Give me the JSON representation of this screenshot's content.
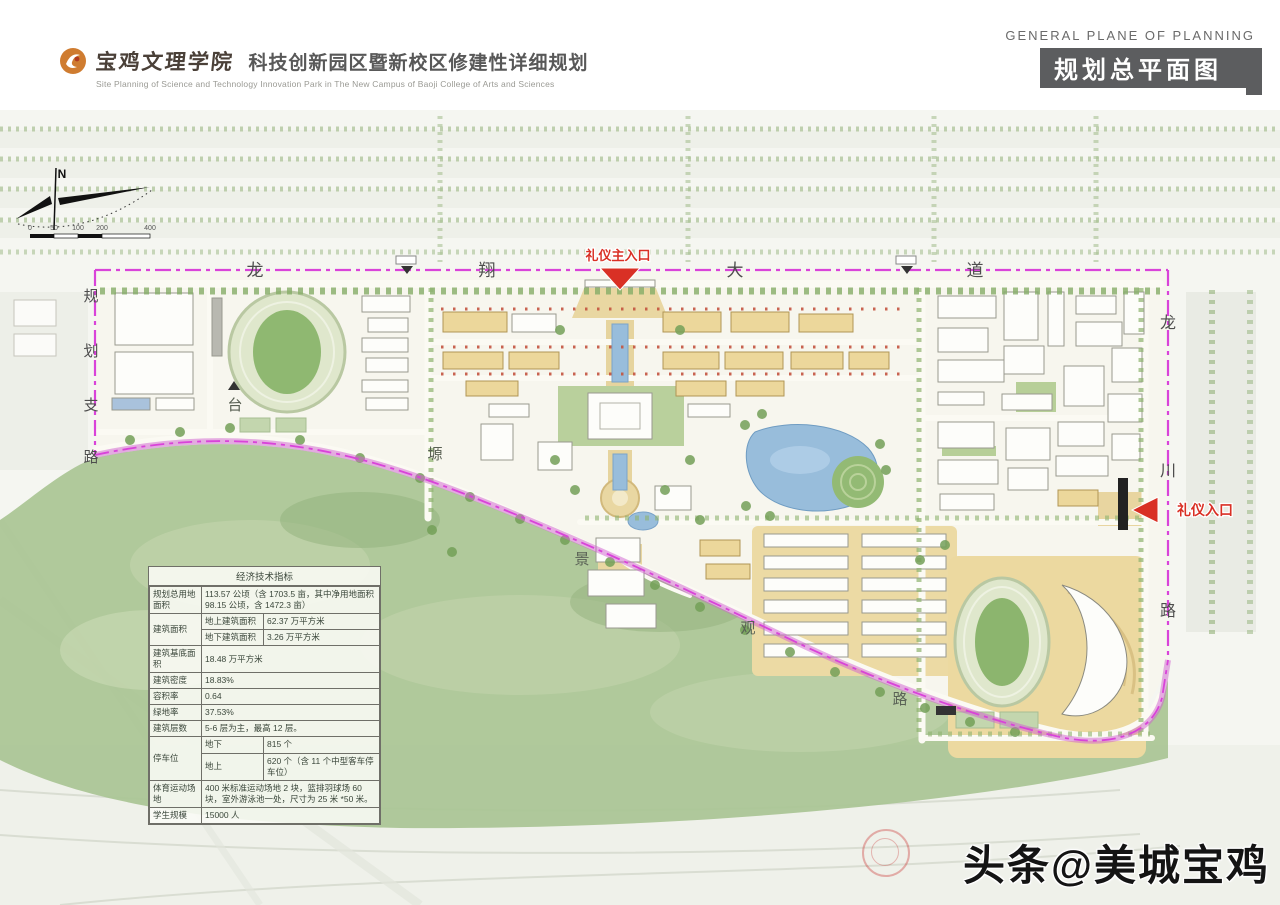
{
  "header": {
    "college": "宝鸡文理学院",
    "title_cn": "科技创新园区暨新校区修建性详细规划",
    "subtitle_en": "Site Planning of Science and Technology Innovation Park in The New Campus of Baoji College of Arts and Sciences",
    "right_title_en": "GENERAL PLANE OF PLANNING",
    "right_title_cn": "规划总平面图"
  },
  "map": {
    "compass_label": "N",
    "scale": {
      "ticks": [
        "0",
        "50",
        "100",
        "200",
        "400"
      ]
    },
    "roads": {
      "top": {
        "name": "龙翔大道",
        "chars": [
          "龙",
          "翔",
          "大",
          "道"
        ]
      },
      "left": {
        "name": "规划支路",
        "chars": [
          "规",
          "划",
          "支",
          "路"
        ]
      },
      "right": {
        "name": "龙川路",
        "chars": [
          "龙",
          "川",
          "路"
        ]
      },
      "slope": {
        "name": "景观路",
        "chars": [
          "景",
          "观",
          "路"
        ]
      }
    },
    "terrain": {
      "name": "台塬",
      "chars": [
        "台",
        "塬"
      ]
    },
    "entrances": {
      "main": "礼仪主入口",
      "side": "礼仪入口"
    },
    "colors": {
      "boundary": "#d943d9",
      "entrance_red": "#d93025",
      "slope_green": "#a9c494",
      "water_blue": "#98bddb",
      "plaza_tan": "#e9d7a2"
    }
  },
  "table": {
    "title": "经济技术指标",
    "r1_label": "规划总用地面积",
    "r1_value": "113.57 公顷（含 1703.5 亩，其中净用地面积 98.15 公顷，含 1472.3 亩）",
    "r2_label": "建筑面积",
    "r2a_sub": "地上建筑面积",
    "r2a_value": "62.37 万平方米",
    "r2b_sub": "地下建筑面积",
    "r2b_value": "3.26 万平方米",
    "r3_label": "建筑基底面积",
    "r3_value": "18.48 万平方米",
    "r4_label": "建筑密度",
    "r4_value": "18.83%",
    "r5_label": "容积率",
    "r5_value": "0.64",
    "r6_label": "绿地率",
    "r6_value": "37.53%",
    "r7_label": "建筑层数",
    "r7_value": "5-6 层为主，最高 12 层。",
    "r8_label": "停车位",
    "r8a_sub": "地下",
    "r8a_value": "815 个",
    "r8b_sub": "地上",
    "r8b_value": "620 个（含 11 个中型客车停车位）",
    "r9_label": "体育运动场地",
    "r9_value": "400 米标准运动场地 2 块，篮排羽球场 60 块，室外游泳池一处，尺寸为 25 米 *50 米。",
    "r10_label": "学生规模",
    "r10_value": "15000 人"
  },
  "watermark": "头条@美城宝鸡"
}
